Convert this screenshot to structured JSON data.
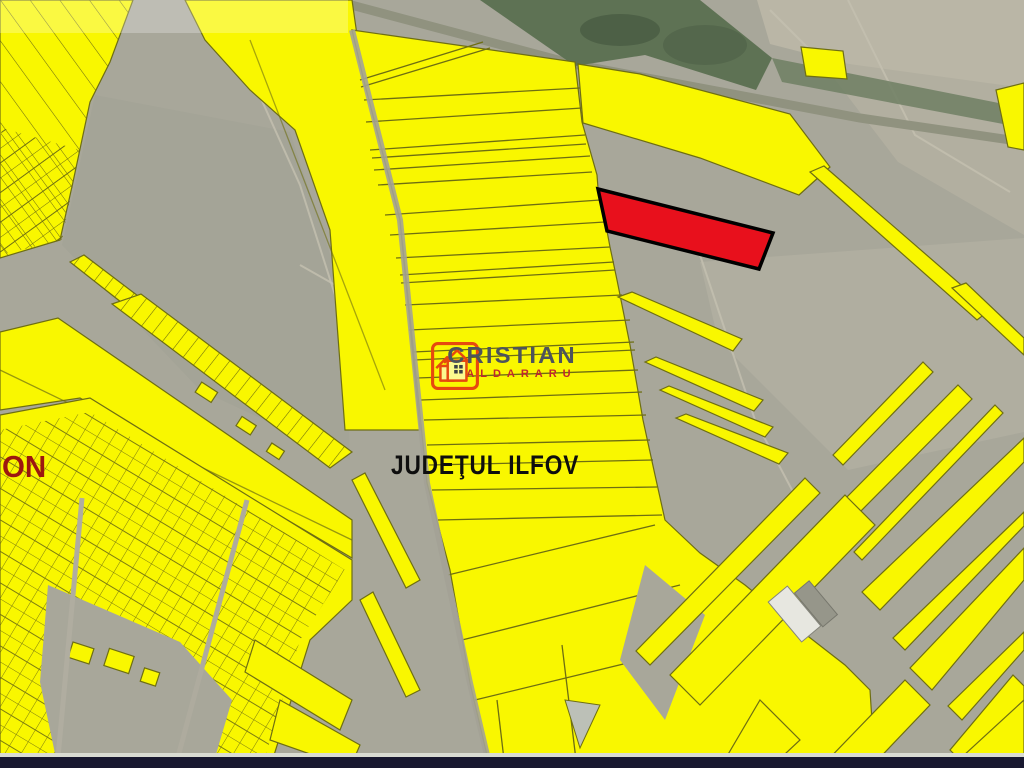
{
  "map": {
    "type": "cadastral-satellite-map",
    "region_label": "JUDEŢUL ILFOV",
    "left_edge_label": "ON",
    "highlighted_parcel": "red-outlined-parcel",
    "colors": {
      "parcel_yellow": "#f9f700",
      "parcel_outline": "#6e6e12",
      "highlight_red": "#e8101c",
      "highlight_outline": "#000000",
      "terrain_gray": "#a8a79a",
      "vegetation_green": "#5e7254",
      "bottom_border_dark": "#181830"
    }
  },
  "watermark": {
    "brand": "CRISTIAN",
    "brand_sub": "CALDARARU",
    "icon": "house-icon",
    "brand_color": "#4d545c",
    "sub_color": "#c1272d"
  }
}
